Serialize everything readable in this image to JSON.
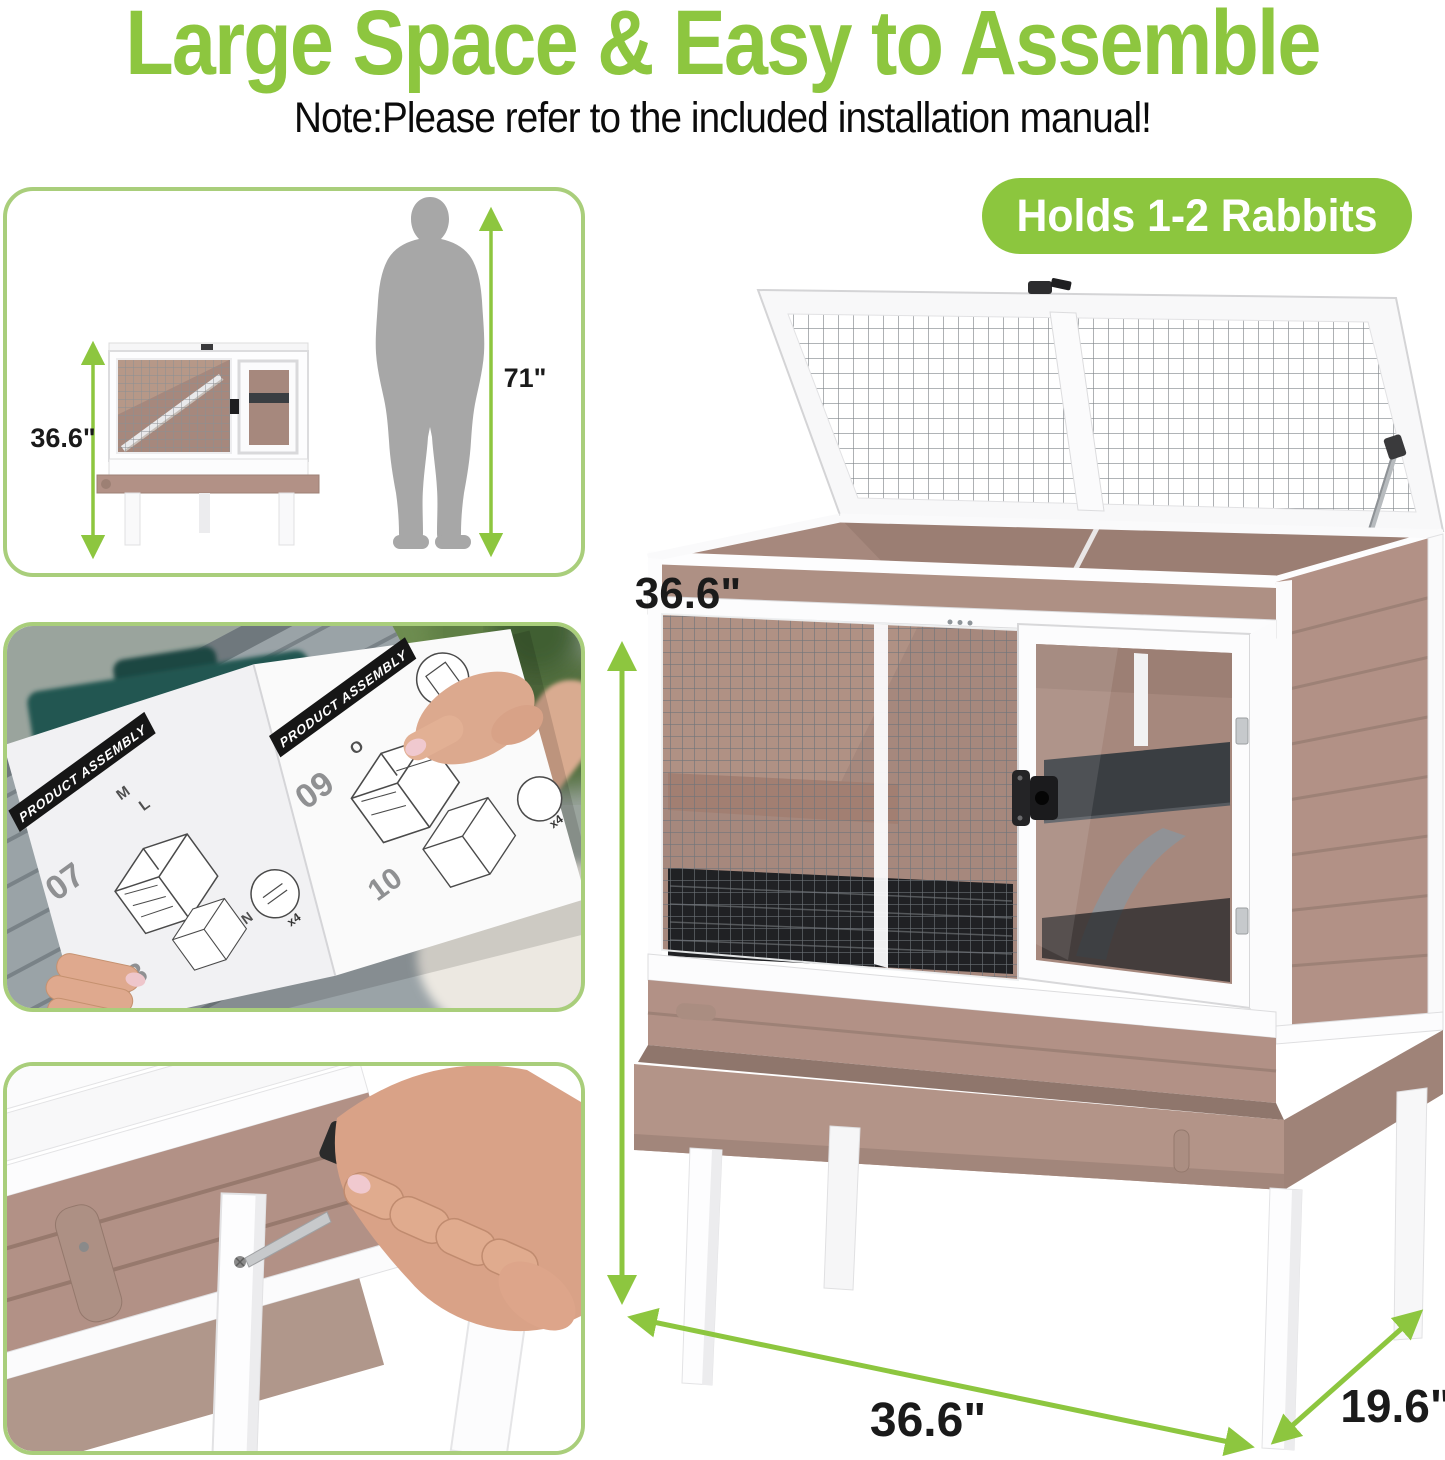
{
  "header": {
    "title": "Large Space & Easy to Assemble",
    "note": "Note:Please refer to the included installation manual!",
    "badge": "Holds 1-2 Rabbits"
  },
  "size_panel": {
    "hutch_height_label": "36.6\"",
    "person_height_label": "71\""
  },
  "manual_panel": {
    "heading": "PRODUCT ASSEMBLY",
    "steps": [
      "07",
      "08",
      "09",
      "10"
    ],
    "parts": [
      "M",
      "L",
      "N",
      "O"
    ],
    "counts": [
      "x2",
      "x4"
    ]
  },
  "main_product": {
    "height_label": "36.6\"",
    "width_label": "36.6\"",
    "depth_label": "19.6\""
  },
  "colors": {
    "accent_green": "#8dc63f",
    "badge_green": "#8cc63e",
    "panel_border": "#a9ce7b",
    "text_dark": "#1a1a1a",
    "wood": "#b29186",
    "wood_dark": "#9b7f73",
    "interior": "#a6887d",
    "shelf": "#3a3e42",
    "silhouette": "#a7a7a7"
  }
}
